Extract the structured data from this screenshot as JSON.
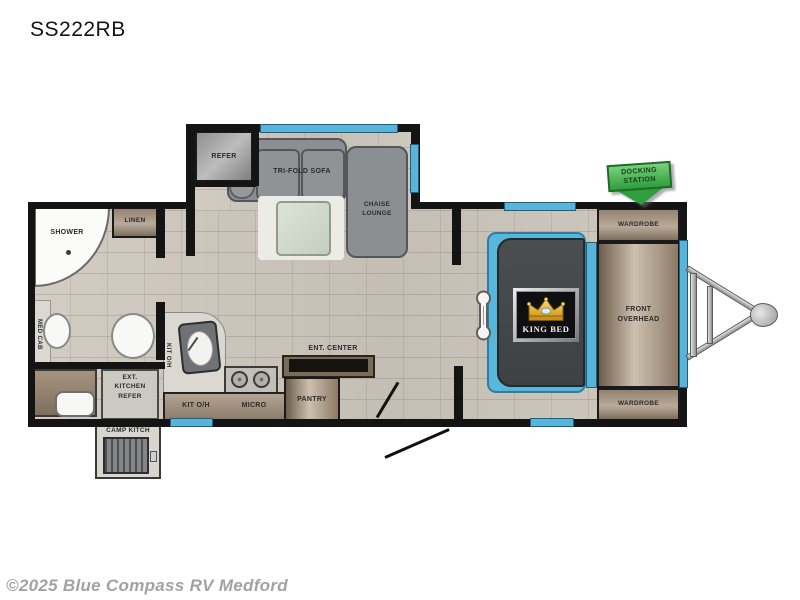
{
  "header": {
    "model": "SS222RB"
  },
  "footer": {
    "copyright": "©2025 Blue Compass RV Medford"
  },
  "floorplan": {
    "slide_out": {
      "refer": "REFER",
      "tri_fold_sofa": "TRI-FOLD SOFA",
      "chaise_lounge": [
        "CHAISE",
        "LOUNGE"
      ]
    },
    "bathroom": {
      "shower": "SHOWER",
      "linen": "LINEN",
      "med_cab": "MED CAB"
    },
    "kitchen": {
      "kit_oh_wall": "KIT O/H",
      "kit_oh_counter": "KIT O/H",
      "micro": "MICRO",
      "pantry": "PANTRY",
      "ent_center": "ENT. CENTER"
    },
    "exterior_kitchen": {
      "ext_refer": [
        "EXT.",
        "KITCHEN",
        "REFER"
      ],
      "camp_kitchen": "CAMP KITCH"
    },
    "bedroom": {
      "king_bed": "KING BED",
      "wardrobe_top": "WARDROBE",
      "wardrobe_bottom": "WARDROBE",
      "front_overhead": [
        "FRONT",
        "OVERHEAD"
      ]
    },
    "docking_station": [
      "DOCKING",
      "STATION"
    ]
  },
  "colors": {
    "wall": "#141414",
    "window_blue": "#58b4d8",
    "cabinet_brown": "#93826f",
    "sofa_gray": "#8c8f92",
    "bed_platform_blue": "#58b6da",
    "mattress_dark": "#46484b",
    "docking_green": "#3fae49",
    "crown_gold": "#e5b23a",
    "copyright_gray": "#a2a2a2"
  }
}
